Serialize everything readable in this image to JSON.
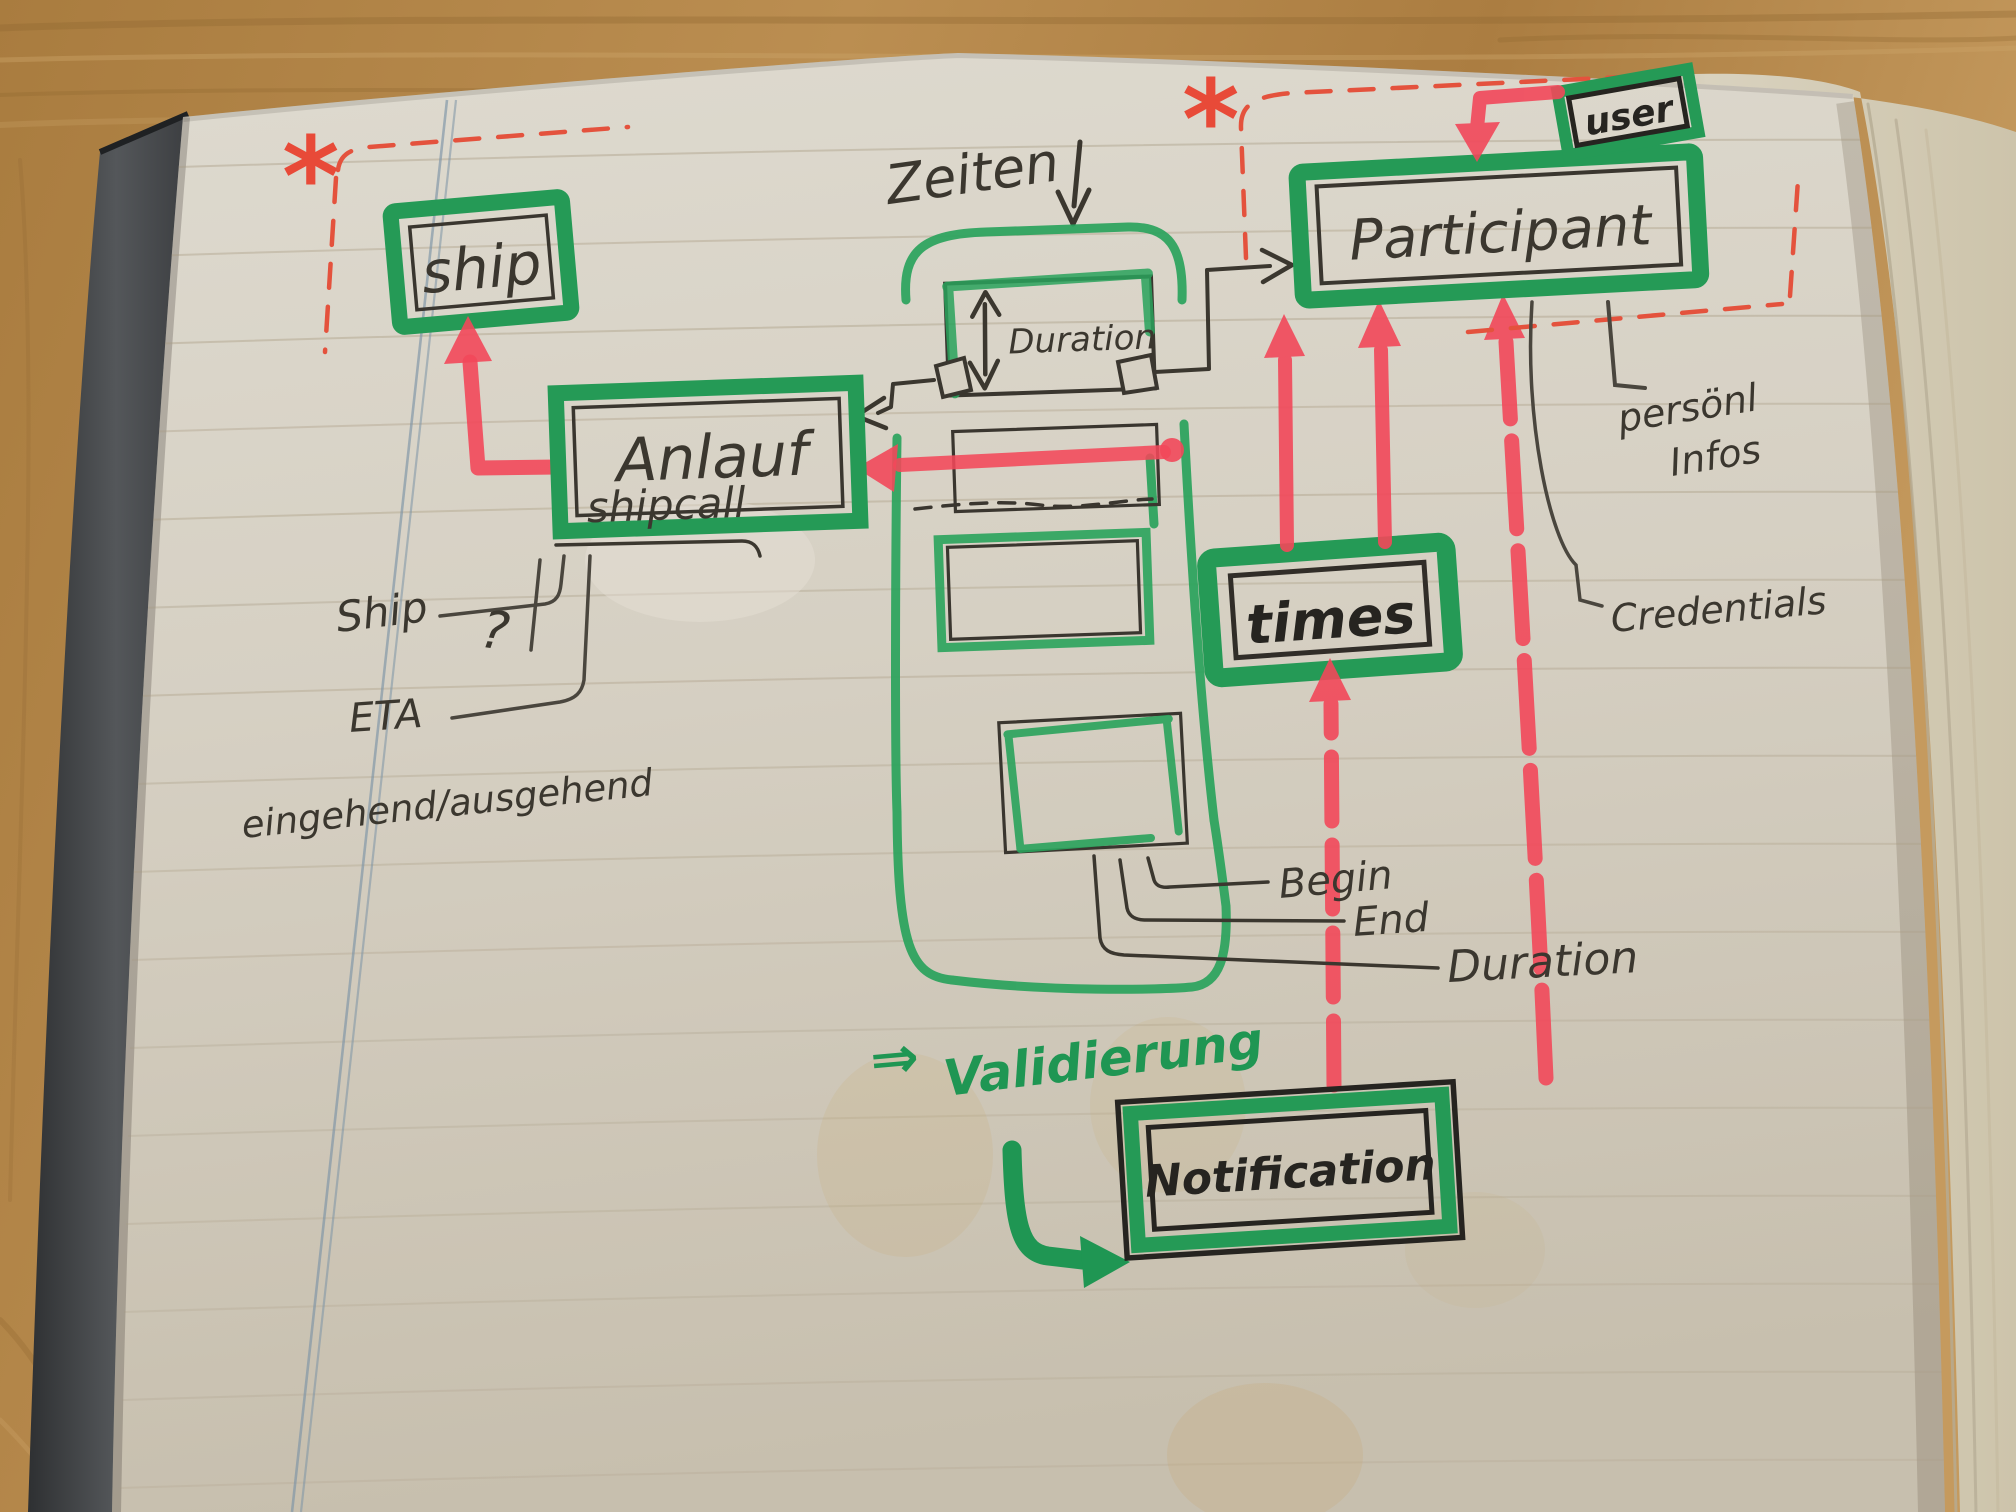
{
  "diagram": {
    "entities": {
      "ship": {
        "label": "ship"
      },
      "anlauf": {
        "label": "Anlauf",
        "sublabel": "shipcall"
      },
      "duration_box": {
        "label": "Duration"
      },
      "participant": {
        "label": "Participant"
      },
      "user": {
        "label": "user"
      },
      "times": {
        "label": "times"
      },
      "notification": {
        "label": "Notification"
      }
    },
    "annotations": {
      "zeiten": "Zeiten",
      "ship_attribute": "Ship",
      "eta_attribute": "ETA",
      "inout_attribute": "eingehend/ausgehend",
      "question_mark": "?",
      "begin_attribute": "Begin",
      "end_attribute": "End",
      "duration_attribute": "Duration",
      "personal_infos_line1": "persönl",
      "personal_infos_line2": "Infos",
      "credentials_attribute": "Credentials",
      "validierung_arrow": "⇒",
      "validierung": "Validierung",
      "asterisk_ship": "*",
      "asterisk_participant": "*"
    },
    "colors": {
      "marker_green": "#2aa05c",
      "marker_red": "#f2485a",
      "pen_red_dashed": "#e4523d",
      "pen_black": "#3b372f",
      "margin_blue": "#7c93a6",
      "paper": "#d6d0c3",
      "wood": "#b48648",
      "cover": "#4a4d50"
    }
  }
}
